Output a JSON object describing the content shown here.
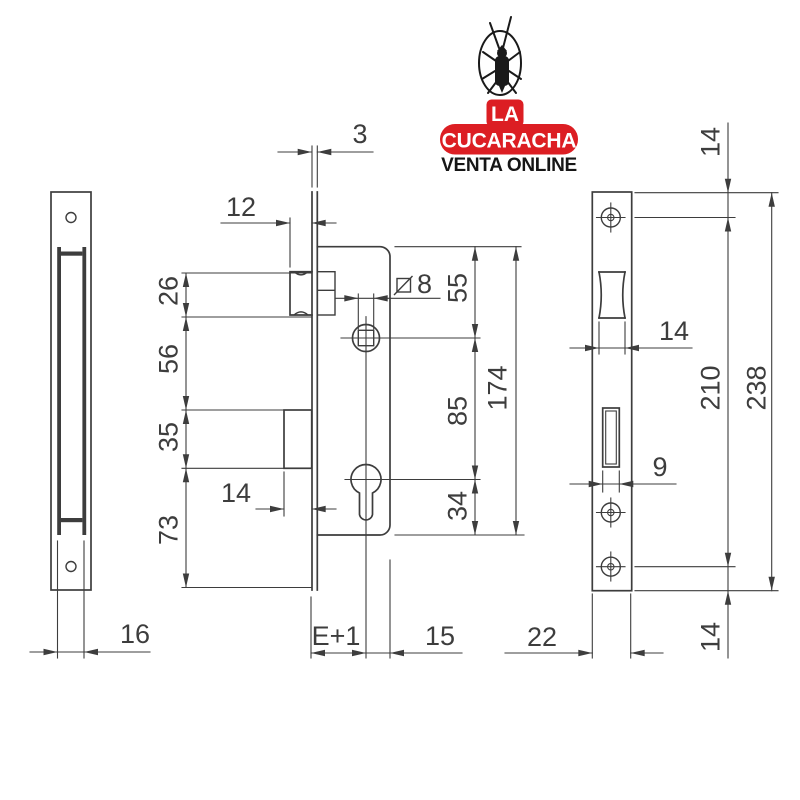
{
  "logo": {
    "badge_top": "LA",
    "badge_main": "CUCARACHA",
    "tagline": "VENTA ONLINE",
    "brand_red": "#dc1e23"
  },
  "drawing": {
    "left_view": {
      "case_thickness": "16"
    },
    "front_view": {
      "plate_thickness": "3",
      "latch_protrusion": "12",
      "latch_height": "26",
      "latch_to_bolt": "56",
      "bolt_height": "35",
      "bolt_to_bottom": "73",
      "bolt_throw": "14",
      "spindle_square": "8",
      "top_to_spindle": "55",
      "spindle_to_cylinder": "85",
      "cylinder_to_bottom": "34",
      "case_length": "174",
      "backset": "E+1",
      "center_to_case_edge": "15"
    },
    "faceplate_view": {
      "plate_top_to_screw": "14",
      "latch_cutout_width": "14",
      "bolt_cutout_width": "9",
      "screw_spacing": "210",
      "plate_length": "238",
      "screw_to_plate_bottom": "14",
      "plate_width": "22"
    }
  }
}
